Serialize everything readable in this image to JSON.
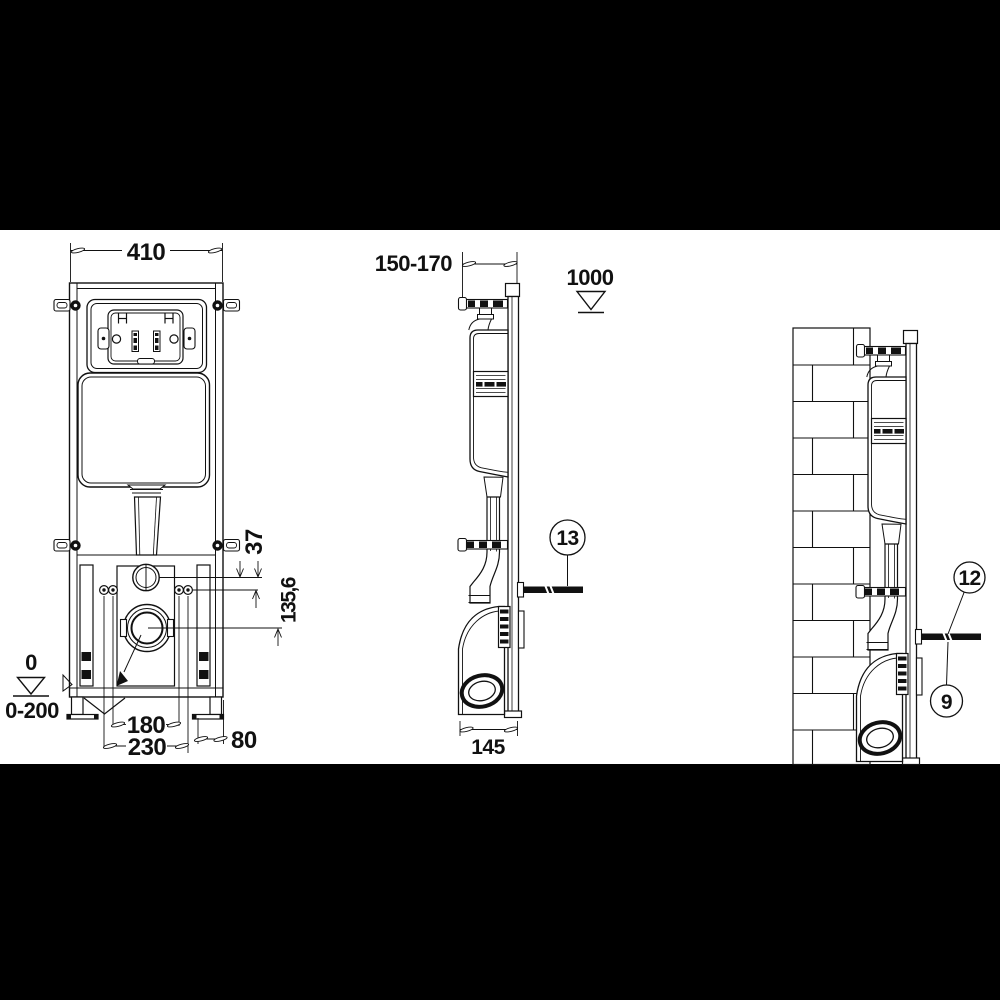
{
  "colors": {
    "letterbox": "#000000",
    "paper": "#ffffff",
    "ink": "#111111"
  },
  "front_view": {
    "width_label": "410",
    "collar_offset_label": "37",
    "outlet_offset_label": "135,6",
    "datum_zero_label": "0",
    "floor_range_label": "0-200",
    "inner_fixing_spacing_label": "180",
    "outer_fixing_spacing_label": "230",
    "edge_offset_label": "80"
  },
  "side_view": {
    "depth_range_label": "150-170",
    "datum_height_label": "1000",
    "outlet_depth_label": "145",
    "stud_callout_label": "13"
  },
  "wall_view": {
    "stud_callout_upper_label": "12",
    "stud_callout_lower_label": "9"
  }
}
